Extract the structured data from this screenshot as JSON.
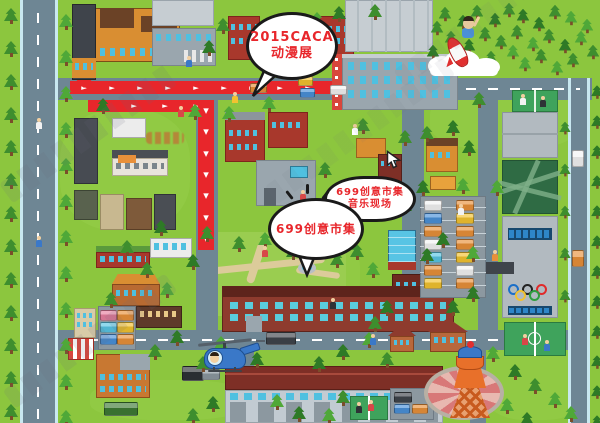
{
  "map": {
    "region_label": "illustrated creative-park campus map",
    "callouts": {
      "anime": {
        "line1": "2015CACA",
        "line2": "动漫展"
      },
      "market_music": {
        "line1": "699创意市集",
        "line2": "音乐现场"
      },
      "market": {
        "line1": "699创意市集"
      }
    },
    "colors": {
      "grass": "#8CC63E",
      "road": "#6E8694",
      "route": "#E8262B",
      "callout_text": "#E8262B",
      "callout_border": "#1A1A1A",
      "window_teal": "#4FC0E0",
      "brick": "#A8382C",
      "factory_gray": "#9AA6AE",
      "olympic_rings": [
        "#1B6FC8",
        "#222222",
        "#E02A2A",
        "#F2C230",
        "#2E9E3E"
      ]
    },
    "icons": [
      "tree-icon",
      "car-icon",
      "bus-icon",
      "truck-icon",
      "helicopter-icon",
      "rocket-boy-icon",
      "cloud-icon",
      "water-tower-icon",
      "olympic-rings-icon",
      "basketball-court",
      "badminton-court",
      "mini-court",
      "fountain-icon",
      "person-icon",
      "cursor-icon",
      "gate-icon",
      "route-arrow-icon",
      "watermark"
    ]
  }
}
